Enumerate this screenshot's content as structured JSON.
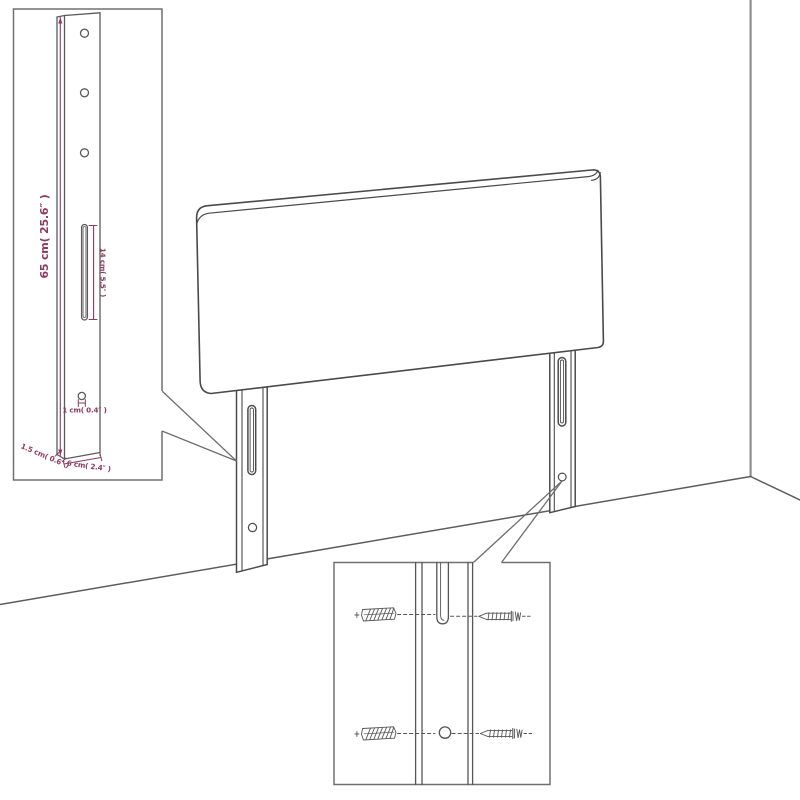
{
  "page": {
    "title": "Headboard dimension diagram",
    "background": "#ffffff"
  },
  "colors": {
    "drawing_line": "#4c4c4c",
    "inset_border": "#707070",
    "wall_line": "#8f8f8f",
    "floor_line": "#5c5c5c",
    "dimension_accent": "#8e3960"
  },
  "main_drawing": {
    "subject": "upholstered headboard panel with two slotted wall-mount legs standing against a room corner"
  },
  "insets": {
    "leg_detail": {
      "subject": "enlarged front view of mounting leg with holes and keyhole slot",
      "labels": {
        "leg_height": "65 cm( 25.6″ )",
        "slot_length": "14 cm( 5.5″ )",
        "hole_diameter": "1 cm( 0.4″ )",
        "leg_thickness": "1.5 cm( 0.6″ )",
        "leg_width": "6 cm( 2.4″ )"
      }
    },
    "mounting_detail": {
      "subject": "close-up of leg slot and hole with wall plugs and screws",
      "icons": [
        "wall-plug-icon",
        "screw-icon"
      ]
    }
  }
}
